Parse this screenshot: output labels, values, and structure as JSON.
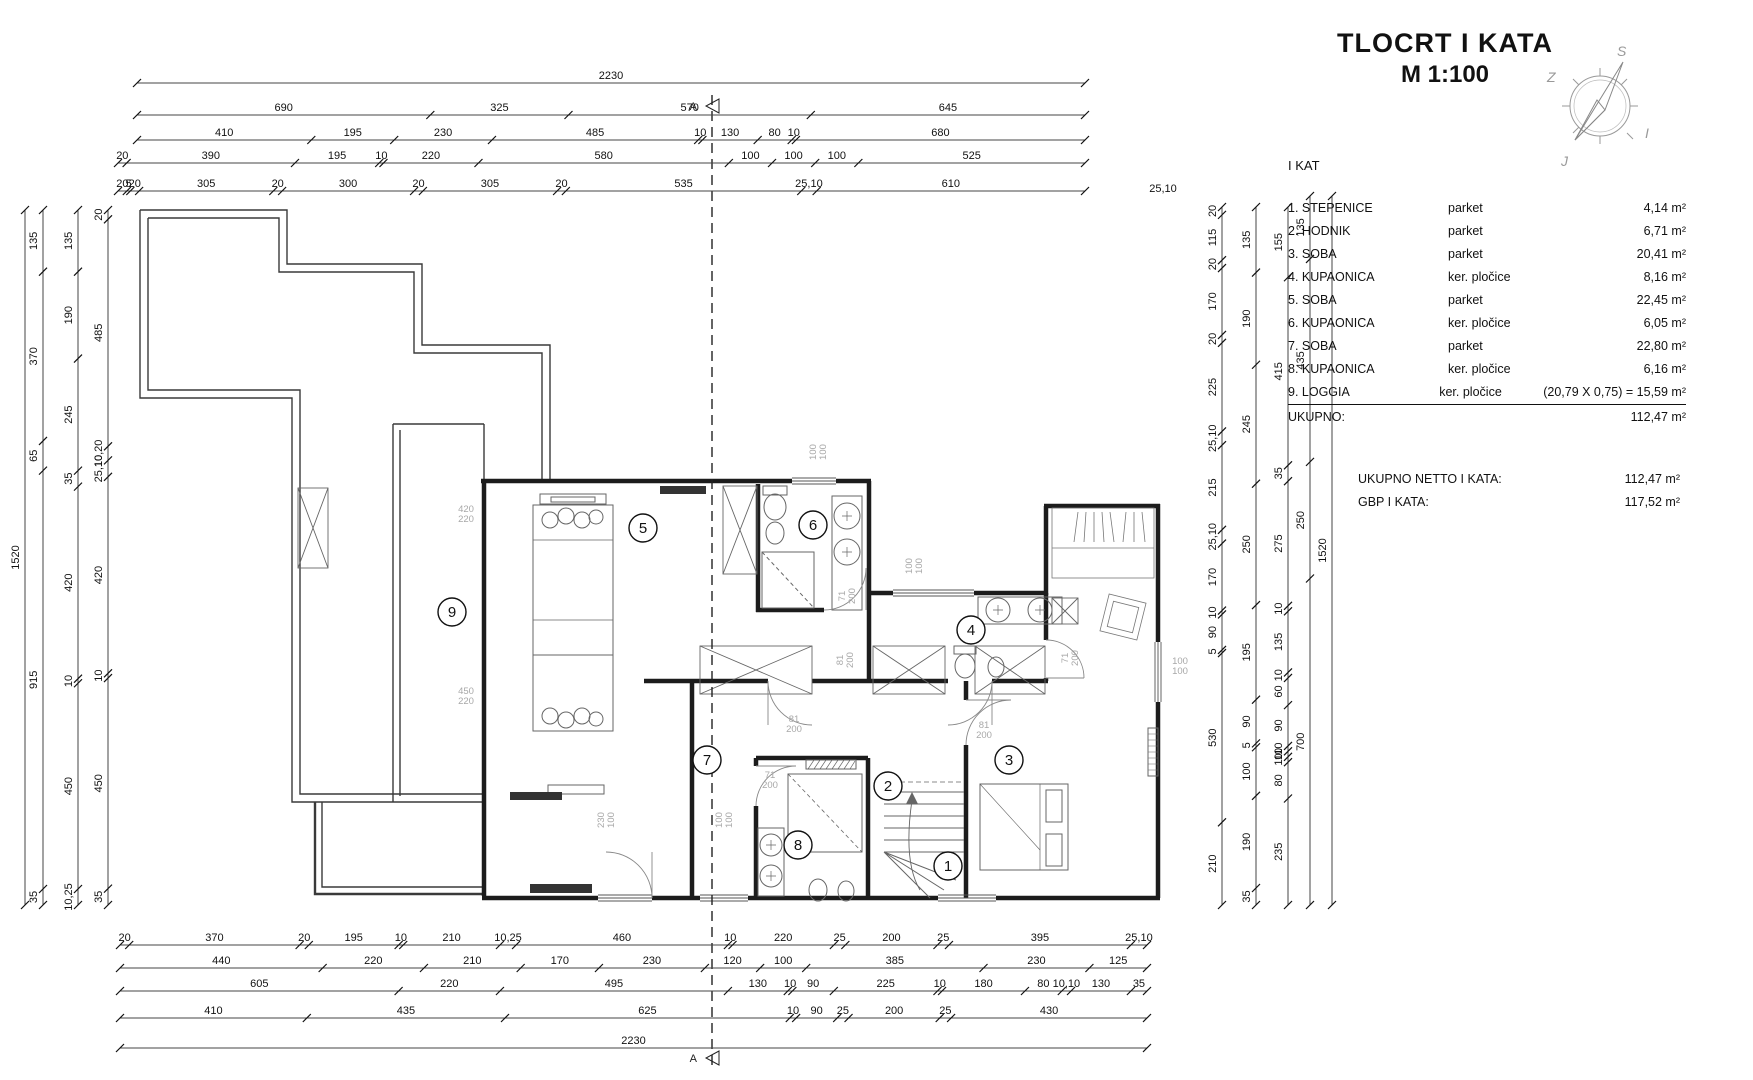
{
  "title": {
    "line1": "TLOCRT  I KATA",
    "line2": "M 1:100"
  },
  "compass": {
    "top": "S",
    "left": "Z",
    "right": "I",
    "bottom": "J"
  },
  "legend": {
    "heading": "I KAT",
    "rows": [
      {
        "num": "1.",
        "name": "STEPENICE",
        "finish": "parket",
        "area": "4,14 m²"
      },
      {
        "num": "2.",
        "name": "HODNIK",
        "finish": "parket",
        "area": "6,71 m²"
      },
      {
        "num": "3.",
        "name": "SOBA",
        "finish": "parket",
        "area": "20,41 m²"
      },
      {
        "num": "4.",
        "name": "KUPAONICA",
        "finish": "ker. pločice",
        "area": "8,16 m²"
      },
      {
        "num": "5.",
        "name": "SOBA",
        "finish": "parket",
        "area": "22,45 m²"
      },
      {
        "num": "6.",
        "name": "KUPAONICA",
        "finish": "ker. pločice",
        "area": "6,05 m²"
      },
      {
        "num": "7.",
        "name": "SOBA",
        "finish": "parket",
        "area": "22,80 m²"
      },
      {
        "num": "8.",
        "name": "KUPAONICA",
        "finish": "ker. pločice",
        "area": "6,16 m²"
      },
      {
        "num": "9.",
        "name": "LOGGIA",
        "finish": "ker. pločice",
        "area": "(20,79 X 0,75) = 15,59 m²"
      }
    ],
    "total_label": "UKUPNO:",
    "total_value": "112,47 m²",
    "netto_label": "UKUPNO NETTO I KATA:",
    "netto_value": "112,47 m²",
    "gbp_label": "GBP I KATA:",
    "gbp_value": "117,52 m²"
  },
  "section_marker": "A",
  "dims": {
    "top_rows": [
      {
        "y": 83,
        "x1": 137,
        "x2": 1085,
        "segs": [
          [
            "2230",
            2230
          ]
        ]
      },
      {
        "y": 115,
        "x1": 137,
        "x2": 1085,
        "segs": [
          [
            "690",
            690
          ],
          [
            "325",
            325
          ],
          [
            "570",
            570
          ],
          [
            "645",
            645
          ]
        ]
      },
      {
        "y": 140,
        "x1": 137,
        "x2": 1085,
        "segs": [
          [
            "410",
            410
          ],
          [
            "195",
            195
          ],
          [
            "230",
            230
          ],
          [
            "485",
            485
          ],
          [
            "10",
            10
          ],
          [
            "130",
            130
          ],
          [
            "80",
            80
          ],
          [
            "10",
            10
          ],
          [
            "680",
            680
          ]
        ]
      },
      {
        "y": 163,
        "x1": 118,
        "x2": 1085,
        "segs": [
          [
            "20",
            20
          ],
          [
            "390",
            390
          ],
          [
            "195",
            195
          ],
          [
            "10",
            10
          ],
          [
            "220",
            220
          ],
          [
            "580",
            580
          ],
          [
            "100",
            100
          ],
          [
            "100",
            100
          ],
          [
            "100",
            100
          ],
          [
            "525",
            525
          ]
        ]
      },
      {
        "y": 191,
        "x1": 118,
        "x2": 1085,
        "segs": [
          [
            "20",
            20
          ],
          [
            "5",
            8
          ],
          [
            "20",
            20
          ],
          [
            "305",
            305
          ],
          [
            "20",
            20
          ],
          [
            "300",
            300
          ],
          [
            "20",
            20
          ],
          [
            "305",
            305
          ],
          [
            "20",
            20
          ],
          [
            "535",
            535
          ],
          [
            "25,10",
            35
          ],
          [
            "610",
            610
          ]
        ]
      }
    ],
    "bottom_rows": [
      {
        "y": 945,
        "x1": 120,
        "x2": 1147,
        "segs": [
          [
            "20",
            20
          ],
          [
            "370",
            370
          ],
          [
            "20",
            20
          ],
          [
            "195",
            195
          ],
          [
            "10",
            10
          ],
          [
            "210",
            210
          ],
          [
            "10,25",
            35
          ],
          [
            "460",
            460
          ],
          [
            "10",
            10
          ],
          [
            "220",
            220
          ],
          [
            "25",
            25
          ],
          [
            "200",
            200
          ],
          [
            "25",
            25
          ],
          [
            "395",
            395
          ],
          [
            "25,10",
            35
          ]
        ]
      },
      {
        "y": 968,
        "x1": 120,
        "x2": 1147,
        "segs": [
          [
            "440",
            440
          ],
          [
            "220",
            220
          ],
          [
            "210",
            210
          ],
          [
            "170",
            170
          ],
          [
            "230",
            230
          ],
          [
            "120",
            120
          ],
          [
            "100",
            100
          ],
          [
            "385",
            385
          ],
          [
            "230",
            230
          ],
          [
            "125",
            125
          ]
        ]
      },
      {
        "y": 991,
        "x1": 120,
        "x2": 1147,
        "segs": [
          [
            "605",
            605
          ],
          [
            "220",
            220
          ],
          [
            "495",
            495
          ],
          [
            "130",
            130
          ],
          [
            "10",
            10
          ],
          [
            "90",
            90
          ],
          [
            "225",
            225
          ],
          [
            "10",
            10
          ],
          [
            "180",
            180
          ],
          [
            "80",
            80
          ],
          [
            "10,10",
            20
          ],
          [
            "130",
            130
          ],
          [
            "35",
            35
          ]
        ]
      },
      {
        "y": 1018,
        "x1": 120,
        "x2": 1147,
        "segs": [
          [
            "410",
            410
          ],
          [
            "435",
            435
          ],
          [
            "625",
            625
          ],
          [
            "10",
            14
          ],
          [
            "90",
            90
          ],
          [
            "25",
            25
          ],
          [
            "200",
            200
          ],
          [
            "25",
            25
          ],
          [
            "430",
            430
          ]
        ]
      },
      {
        "y": 1048,
        "x1": 120,
        "x2": 1147,
        "segs": [
          [
            "2230",
            2230
          ]
        ]
      }
    ],
    "left_cols": [
      {
        "x": 25,
        "y1": 210,
        "y2": 905,
        "segs": [
          [
            "1520",
            1520
          ]
        ]
      },
      {
        "x": 43,
        "y1": 210,
        "y2": 905,
        "segs": [
          [
            "135",
            135
          ],
          [
            "370",
            370
          ],
          [
            "65",
            65
          ],
          [
            "915",
            915
          ],
          [
            "35",
            35
          ]
        ]
      },
      {
        "x": 78,
        "y1": 210,
        "y2": 905,
        "segs": [
          [
            "135",
            135
          ],
          [
            "190",
            190
          ],
          [
            "245",
            245
          ],
          [
            "35",
            35
          ],
          [
            "420",
            420
          ],
          [
            "10",
            10
          ],
          [
            "450",
            450
          ],
          [
            "10,25",
            35
          ]
        ]
      },
      {
        "x": 108,
        "y1": 210,
        "y2": 905,
        "segs": [
          [
            "20",
            20
          ],
          [
            "485",
            485
          ],
          [
            "10,20",
            30
          ],
          [
            "25,10",
            35
          ],
          [
            "420",
            420
          ],
          [
            "10",
            10
          ],
          [
            "450",
            450
          ],
          [
            "35",
            35
          ]
        ]
      }
    ],
    "right_cols": [
      {
        "x": 1222,
        "y1": 207,
        "y2": 905,
        "segs": [
          [
            "20",
            20
          ],
          [
            "115",
            115
          ],
          [
            "20",
            20
          ],
          [
            "170",
            170
          ],
          [
            "20",
            20
          ],
          [
            "225",
            225
          ],
          [
            "25,10",
            35
          ],
          [
            "215",
            215
          ],
          [
            "25,10",
            35
          ],
          [
            "170",
            170
          ],
          [
            "10",
            10
          ],
          [
            "90",
            90
          ],
          [
            "5",
            8
          ],
          [
            "530",
            430
          ],
          [
            "210",
            210
          ]
        ]
      },
      {
        "x": 1256,
        "y1": 207,
        "y2": 905,
        "segs": [
          [
            "135",
            135
          ],
          [
            "190",
            190
          ],
          [
            "245",
            245
          ],
          [
            "250",
            250
          ],
          [
            "195",
            195
          ],
          [
            "90",
            90
          ],
          [
            "5",
            8
          ],
          [
            "100",
            100
          ],
          [
            "190",
            190
          ],
          [
            "35",
            35
          ]
        ]
      },
      {
        "x": 1288,
        "y1": 207,
        "y2": 905,
        "segs": [
          [
            "155",
            155
          ],
          [
            "415",
            415
          ],
          [
            "35",
            35
          ],
          [
            "275",
            275
          ],
          [
            "10",
            12
          ],
          [
            "135",
            135
          ],
          [
            "10",
            12
          ],
          [
            "60",
            60
          ],
          [
            "90",
            90
          ],
          [
            "10",
            12
          ],
          [
            "10",
            12
          ],
          [
            "10",
            12
          ],
          [
            "80",
            80
          ],
          [
            "235",
            235
          ]
        ]
      },
      {
        "x": 1310,
        "y1": 196,
        "y2": 905,
        "segs": [
          [
            "135",
            135
          ],
          [
            "435",
            435
          ],
          [
            "250",
            250
          ],
          [
            "700",
            700
          ]
        ]
      },
      {
        "x": 1332,
        "y1": 196,
        "y2": 905,
        "segs": [
          [
            "1520",
            1520
          ]
        ]
      }
    ],
    "extra_labels": [
      {
        "t": "25,10",
        "x": 1163,
        "y": 192
      }
    ]
  },
  "plan": {
    "rooms": [
      {
        "n": "1",
        "x": 948,
        "y": 866
      },
      {
        "n": "2",
        "x": 888,
        "y": 786
      },
      {
        "n": "3",
        "x": 1009,
        "y": 760
      },
      {
        "n": "4",
        "x": 971,
        "y": 630
      },
      {
        "n": "5",
        "x": 643,
        "y": 528
      },
      {
        "n": "6",
        "x": 813,
        "y": 525
      },
      {
        "n": "7",
        "x": 707,
        "y": 760
      },
      {
        "n": "8",
        "x": 798,
        "y": 845
      },
      {
        "n": "9",
        "x": 452,
        "y": 612
      }
    ],
    "labels": [
      {
        "t": "420|220",
        "x": 466,
        "y": 512,
        "rot": 0
      },
      {
        "t": "450|220",
        "x": 466,
        "y": 694,
        "rot": 0
      },
      {
        "t": "100|100",
        "x": 816,
        "y": 452,
        "rot": -90
      },
      {
        "t": "100|100",
        "x": 912,
        "y": 566,
        "rot": -90
      },
      {
        "t": "100|100",
        "x": 1180,
        "y": 664,
        "rot": 0
      },
      {
        "t": "100|100",
        "x": 722,
        "y": 820,
        "rot": -90
      },
      {
        "t": "230|100",
        "x": 604,
        "y": 820,
        "rot": -90
      },
      {
        "t": "81|200",
        "x": 843,
        "y": 660,
        "rot": -90
      },
      {
        "t": "81|200",
        "x": 794,
        "y": 722,
        "rot": 0
      },
      {
        "t": "81|200",
        "x": 984,
        "y": 728,
        "rot": 0
      },
      {
        "t": "71|200",
        "x": 845,
        "y": 596,
        "rot": -90
      },
      {
        "t": "71|200",
        "x": 770,
        "y": 778,
        "rot": 0
      },
      {
        "t": "71|200",
        "x": 1068,
        "y": 658,
        "rot": -90
      }
    ]
  }
}
